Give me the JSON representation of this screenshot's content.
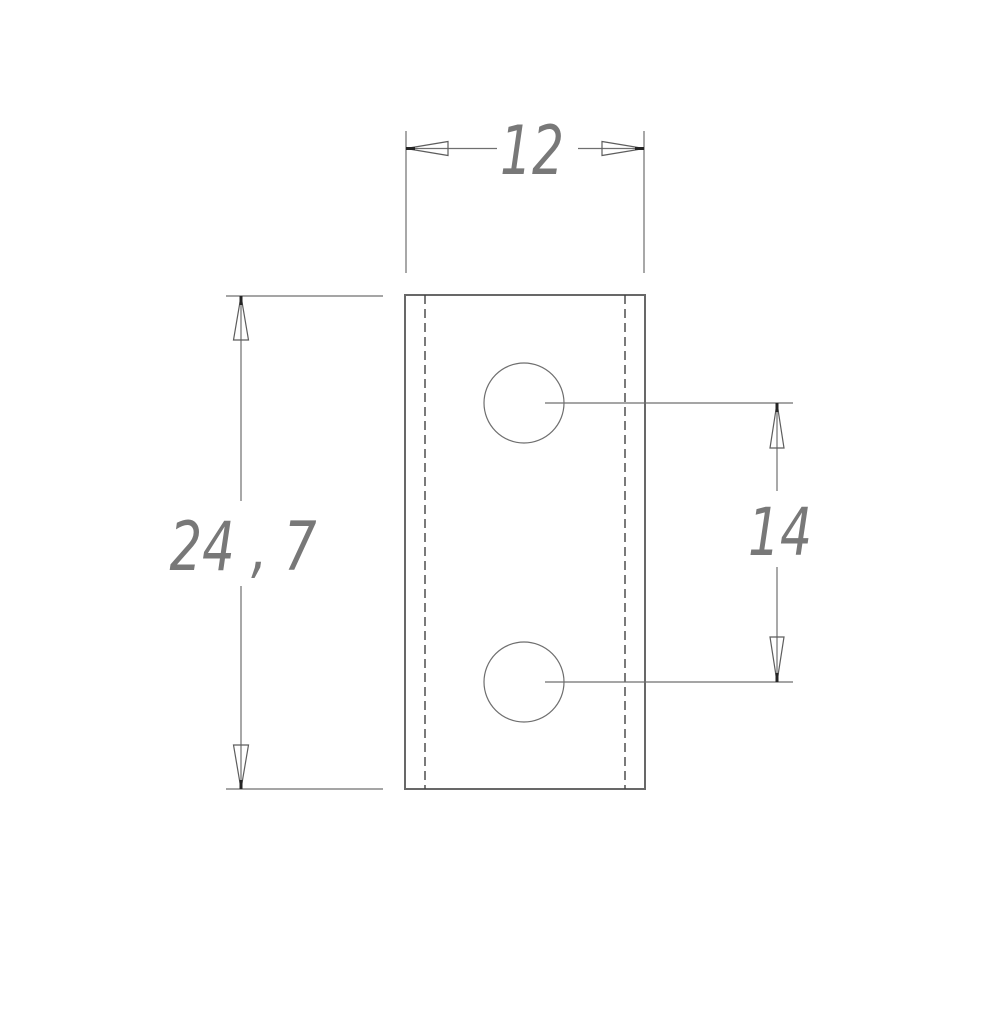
{
  "drawing": {
    "view": "front view of rectangular plate with two holes",
    "dimensions": {
      "width": {
        "label": "12",
        "orientation": "horizontal",
        "applies_to": "plate outer width"
      },
      "height": {
        "label": "24 , 7",
        "orientation": "vertical",
        "applies_to": "plate outer height"
      },
      "hole_spacing": {
        "label": "14",
        "orientation": "vertical",
        "applies_to": "center distance between the two holes"
      }
    },
    "features": {
      "holes": 2,
      "hidden_lines": 2
    },
    "colors": {
      "background": "#ffffff",
      "line": "#6f6f6f",
      "outline": "#686868",
      "hidden_line": "#414141",
      "text": "#787878",
      "arrow_tip": "#242424"
    }
  }
}
